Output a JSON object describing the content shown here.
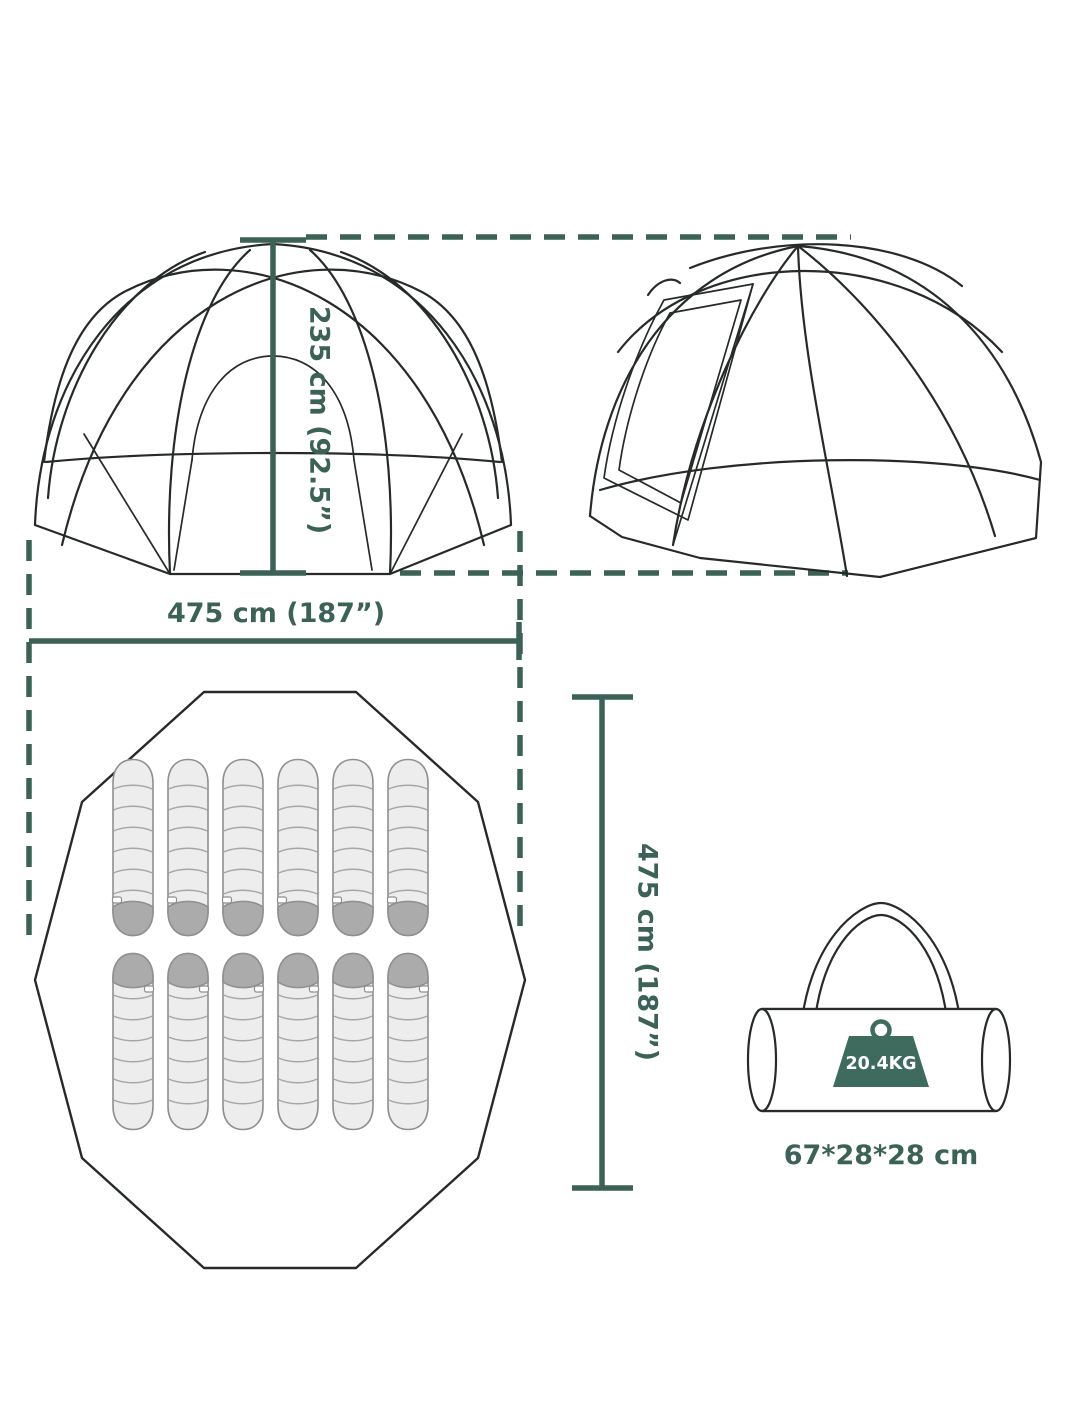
{
  "labels": {
    "height": "235 cm (92.5”)",
    "width": "475 cm (187”)",
    "depth": "475 cm (187”)",
    "bag_weight": "20.4KG",
    "bag_size": "67*28*28 cm"
  },
  "colors": {
    "dimension": "#3c6156",
    "outline": "#262b27",
    "bag_fill": "#ededed",
    "bag_stroke": "#8f8f8f",
    "hood": "#ababab",
    "weight_block": "#3e6b5e"
  },
  "floor_plan": {
    "rows": 2,
    "bags_per_row": 6,
    "bag_count": 12
  }
}
